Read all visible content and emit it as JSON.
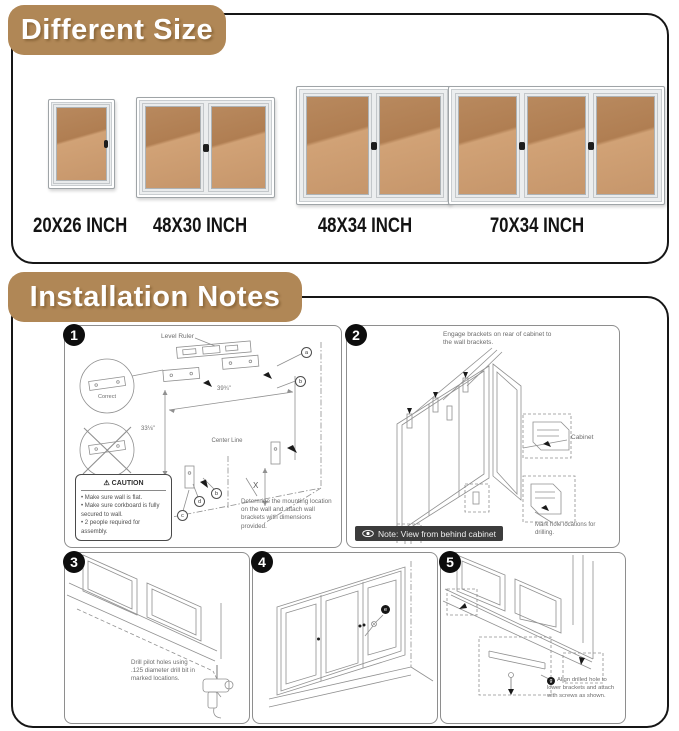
{
  "different_size": {
    "title": "Different Size",
    "boards": [
      {
        "label": "20X26 INCH",
        "doors": 1
      },
      {
        "label": "48X30 INCH",
        "doors": 2
      },
      {
        "label": "48X34 INCH",
        "doors": 2
      },
      {
        "label": "70X34 INCH",
        "doors": 3
      }
    ]
  },
  "installation": {
    "title": "Installation Notes",
    "step1": {
      "number": "1",
      "level_ruler": "Level Ruler",
      "correct": "Correct",
      "width_dim": "39¾\"",
      "height_dim": "33⅛\"",
      "center_line": "Center Line",
      "x_dim": "X",
      "callout_a": "a",
      "callout_b": "b",
      "callout_c": "c",
      "callout_d": "d",
      "callout_b2": "b",
      "caution_icon": "⚠",
      "caution_title": "CAUTION",
      "caution_items": [
        "Make sure wall is flat.",
        "Make sure corkboard is fully secured to wall.",
        "2 people required for assembly."
      ],
      "note": "Determine the mounting location on the wall and attach wall brackets with dimensions provided."
    },
    "step2": {
      "number": "2",
      "instruction": "Engage brackets on rear of cabinet to the wall brackets.",
      "cabinet_label": "Cabinet",
      "mark_note": "Mark hole locations for drilling.",
      "view_note": "Note: View from behind cabinet"
    },
    "step3": {
      "number": "3",
      "instruction": "Drill pilot holes using .125 diameter drill bit in marked locations."
    },
    "step4": {
      "number": "4",
      "callout": "e"
    },
    "step5": {
      "number": "5",
      "callout": "g",
      "instruction": "Align drilled hole to lower brackets and attach with screws as shown."
    }
  },
  "colors": {
    "accent_tan": "#b08756",
    "cork_light": "#d1a276",
    "cork_dark": "#b07e52",
    "frame_silver": "#eceeef",
    "line_art": "#909090"
  }
}
